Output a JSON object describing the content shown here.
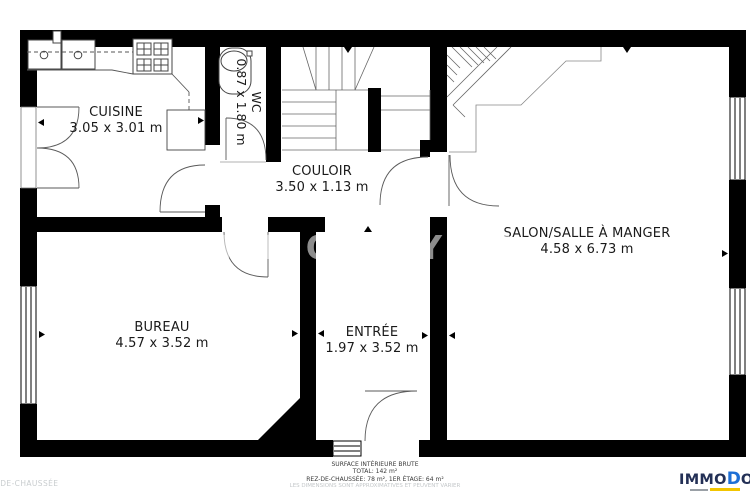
{
  "plan": {
    "rooms": [
      {
        "name": "CUISINE",
        "dims": "3.05 x 3.01 m"
      },
      {
        "name": "WC",
        "dims": "0.87 x 1.80 m"
      },
      {
        "name": "COULOIR",
        "dims": "3.50 x 1.13 m"
      },
      {
        "name": "SALON/SALLE À MANGER",
        "dims": "4.58 x 6.73 m"
      },
      {
        "name": "BUREAU",
        "dims": "4.57 x 3.52 m"
      },
      {
        "name": "ENTRÉE",
        "dims": "1.97 x 3.52 m"
      }
    ],
    "watermark": "IMMODOYEN",
    "floor_label": "REZ-DE-CHAUSSÉE"
  },
  "footer": {
    "line1": "SURFACE INTÉRIEURE BRUTE",
    "line2": "TOTAL: 142 m²",
    "line3": "REZ-DE-CHAUSSÉE: 78 m², 1ER ÉTAGE: 64 m²",
    "line4": "LES DIMENSIONS SONT APPROXIMATIVES ET PEUVENT VARIER"
  },
  "logo": {
    "part1": "IMMO",
    "part2": "D",
    "part3": "OYEN"
  },
  "colors": {
    "wall": "#000000",
    "logo_navy": "#233056",
    "logo_blue": "#1d6fd6",
    "highlight_yellow": "#f2c500"
  }
}
